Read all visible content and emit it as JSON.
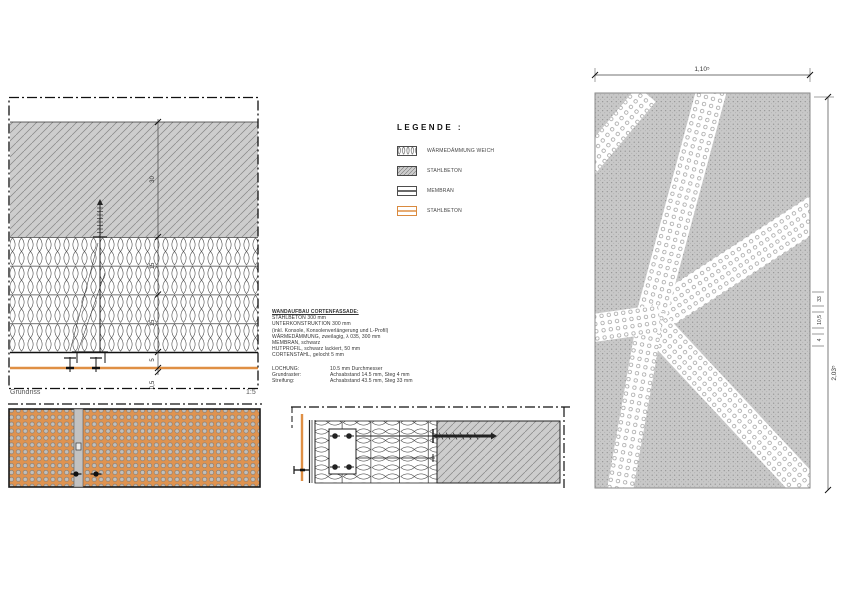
{
  "colors": {
    "corten_orange": "#df8f44",
    "concrete_gray": "#cdcdcd",
    "perforation_gray": "#bcbab6",
    "line_black": "#1a1a1a"
  },
  "legend": {
    "title": "LEGENDE :",
    "items": [
      {
        "swatch": "insulation-soft-pattern",
        "label": "WÄRMEDÄMMUNG WEICH"
      },
      {
        "swatch": "concrete-hatch-pattern",
        "label": "STAHLBETON"
      },
      {
        "swatch": "membrane-line",
        "label": "MEMBRAN"
      },
      {
        "swatch": "corten-orange-line",
        "label": "STAHLBETON"
      }
    ]
  },
  "wall_spec": {
    "title": "WANDAUFBAU CORTENFASSADE:",
    "lines": [
      "STAHLBETON 300 mm",
      "UNTERKONSTRUKTION 300 mm",
      "(inkl. Konsole, Konsolenverlängerung und L-Profil)",
      "WÄRMEDÄMMUNG, zweilagig, λ 035, 300 mm",
      "MEMBRAN, schwarz",
      "HUTPROFIL, schwarz lackiert, 50 mm",
      "CORTENSTAHL, gelocht 5 mm"
    ],
    "perforation": {
      "rows": [
        {
          "label": "LOCHUNG:",
          "value": "10.5 mm Durchmesser"
        },
        {
          "label": "Grundraster:",
          "value": "Achsabstand 14.5 mm, Steg 4 mm"
        },
        {
          "label": "Streifung:",
          "value": "Achsabstand 43.5 mm, Steg 33 mm"
        }
      ]
    }
  },
  "plan_detail": {
    "caption": "Grundriss",
    "scale": "1:5",
    "dims": {
      "concrete": "30",
      "insulation_layer1": "15",
      "insulation_layer2": "15",
      "hut_profile": "5",
      "corten": "0,5"
    }
  },
  "elevation": {
    "width_dim": "1,10⁵",
    "height_dim": "2,03⁵",
    "perforation_dims": [
      "33",
      "10,5",
      "4"
    ]
  }
}
